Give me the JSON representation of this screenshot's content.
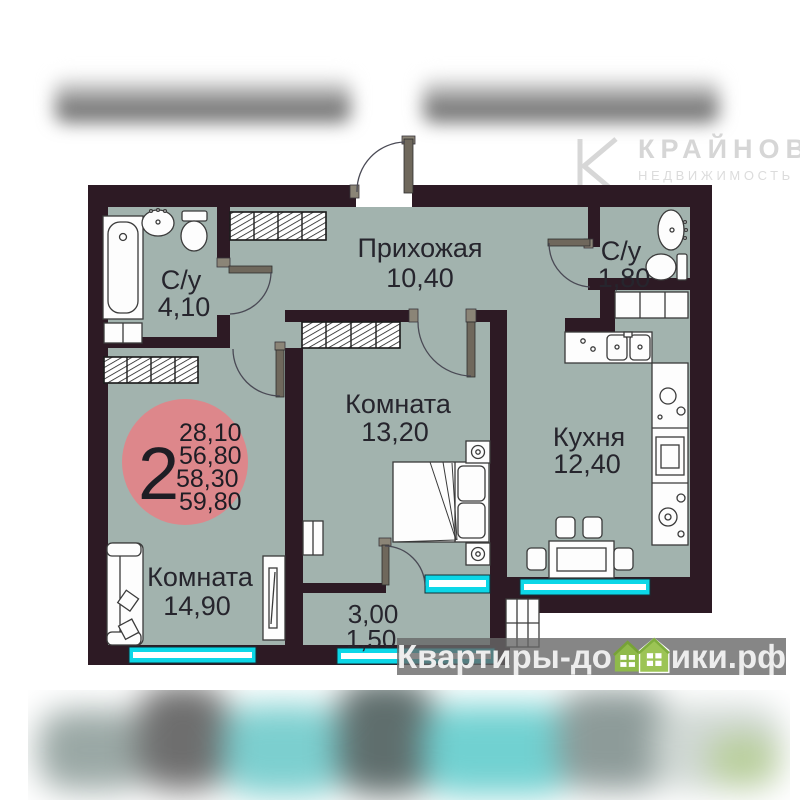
{
  "branding": {
    "agency_name": "КРАЙНОВ",
    "agency_tagline": "НЕДВИЖИМОСТЬ"
  },
  "site_watermark": {
    "text_before_houses": "Квартиры-до",
    "text_after_houses": "ики.рф",
    "full_text": "Квартиры-домики.рф",
    "house_color": "#93bf4e"
  },
  "apartment": {
    "summary": {
      "room_count": "2",
      "a1": "28,10",
      "a2": "56,80",
      "a3": "58,30",
      "a4": "59,80"
    },
    "rooms": {
      "hallway": {
        "name": "Прихожая",
        "area": "10,40"
      },
      "bathroom_main": {
        "name": "С/у",
        "area": "4,10"
      },
      "bathroom_guest": {
        "name": "С/у",
        "area": "1,80"
      },
      "bedroom": {
        "name": "Комната",
        "area": "13,20"
      },
      "kitchen": {
        "name": "Кухня",
        "area": "12,40"
      },
      "living_room": {
        "name": "Комната",
        "area": "14,90"
      },
      "balcony": {
        "area_1": "3,00",
        "area_2": "1,50"
      }
    }
  },
  "colors": {
    "wall": "#2d1a24",
    "floor": "#a2b3ae",
    "window_frame": "#0cd7e7",
    "summary_badge": "#dd878b"
  }
}
